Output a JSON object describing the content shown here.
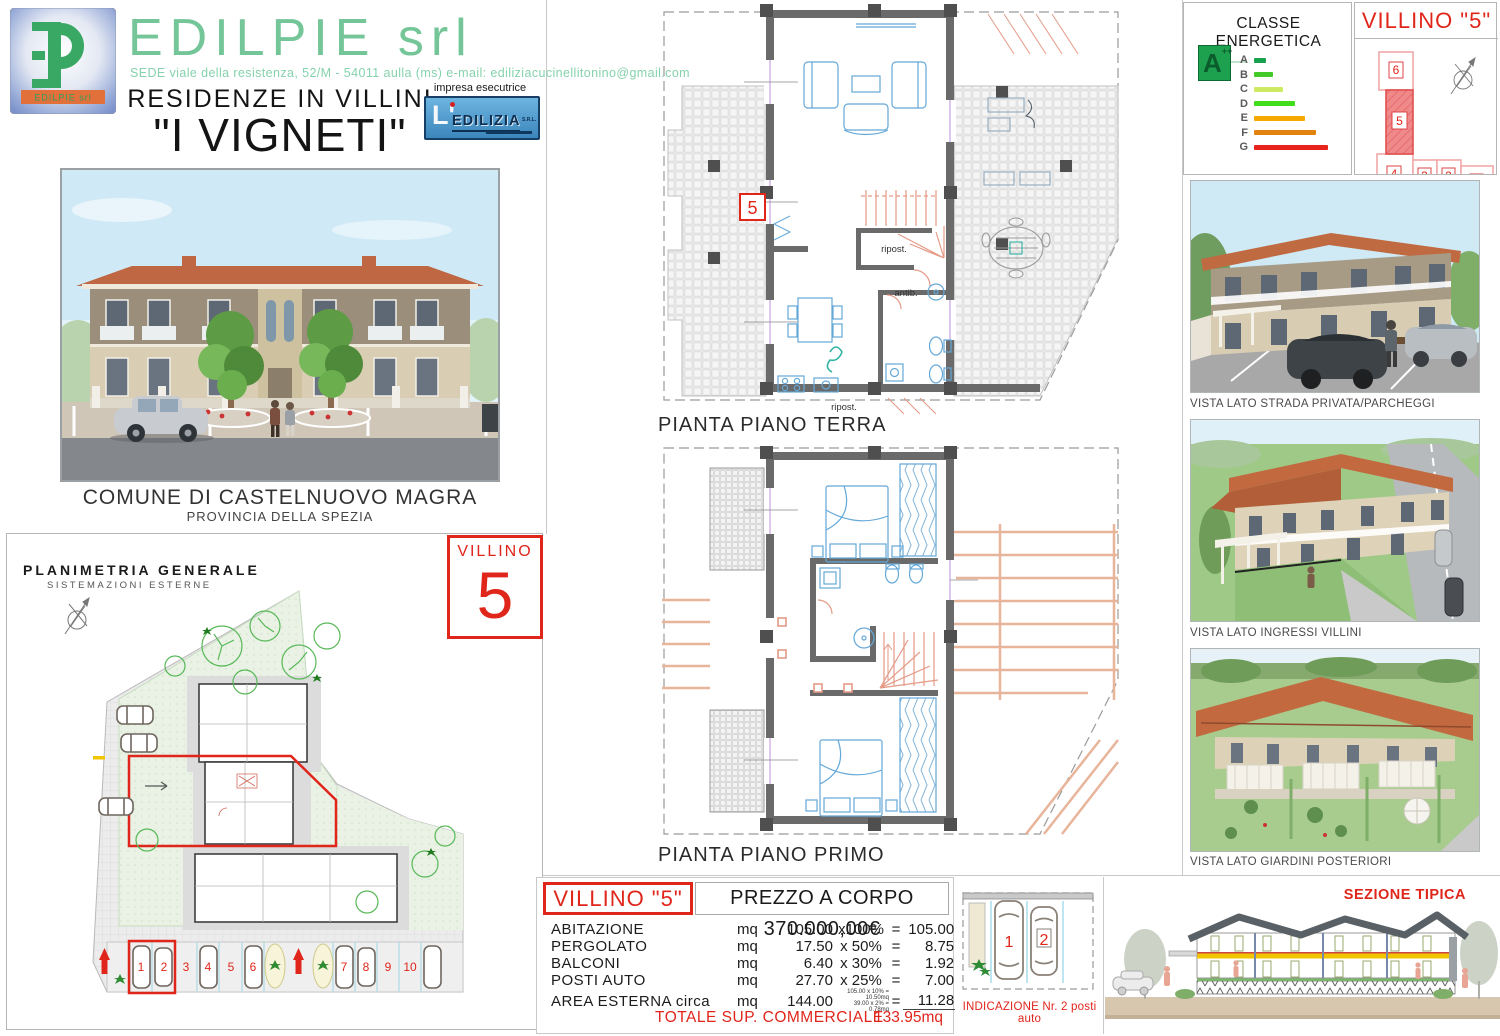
{
  "colors": {
    "brand_green": "#74c698",
    "address_green": "#85d2ad",
    "accent_red": "#e0251b",
    "plan_wall_gray": "#6a6a6a",
    "furniture_blue": "#64a8d8",
    "stairs_salmon": "#e59a86"
  },
  "header": {
    "company": "EDILPIE srl",
    "address": "SEDE viale della resistenza, 52/M - 54011 aulla (ms) e-mail: ediliziacucinellitonino@gmail.com",
    "logo_caption": "EDILPIE srl",
    "subtitle": "RESIDENZE IN VILLINI",
    "title": "\"I VIGNETI\"",
    "contractor_label": "impresa esecutrice",
    "contractor_name": "EDILIZIA",
    "contractor_prefix": "L'",
    "contractor_suffix": "S.R.L."
  },
  "location": {
    "municipality": "COMUNE DI CASTELNUOVO MAGRA",
    "province": "PROVINCIA DELLA SPEZIA"
  },
  "site_plan": {
    "title": "PLANIMETRIA GENERALE",
    "subtitle": "SISTEMAZIONI ESTERNE",
    "parking_numbers": [
      "1",
      "2",
      "3",
      "4",
      "5",
      "6",
      "7",
      "8",
      "9",
      "10"
    ]
  },
  "villino_badge": {
    "label": "VILLINO",
    "number": "5"
  },
  "floor_plans": {
    "ground": {
      "caption": "PIANTA PIANO TERRA",
      "marker": "5",
      "label_storage": "ripost.",
      "label_anteroom": "antib.",
      "label_storage2": "ripost."
    },
    "first": {
      "caption": "PIANTA PIANO PRIMO"
    }
  },
  "energy": {
    "title": "CLASSE ENERGETICA",
    "rating_letter": "A",
    "rating_sup": "++",
    "classes": [
      {
        "label": "A",
        "color": "#17a04d",
        "width": "12px"
      },
      {
        "label": "B",
        "color": "#44ca28",
        "width": "19px"
      },
      {
        "label": "C",
        "color": "#cdea62",
        "width": "29px"
      },
      {
        "label": "D",
        "color": "#3fdd1a",
        "width": "41px"
      },
      {
        "label": "E",
        "color": "#f6a800",
        "width": "51px"
      },
      {
        "label": "F",
        "color": "#e2820f",
        "width": "62px"
      },
      {
        "label": "G",
        "color": "#e8231c",
        "width": "74px"
      }
    ]
  },
  "unit_map": {
    "title": "VILLINO \"5\"",
    "units": [
      "6",
      "5",
      "4",
      "3",
      "2",
      "1"
    ],
    "highlighted": "5"
  },
  "views": {
    "street": "VISTA LATO STRADA PRIVATA/PARCHEGGI",
    "entrances": "VISTA LATO INGRESSI VILLINI",
    "gardens": "VISTA LATO GIARDINI POSTERIORI"
  },
  "price_table": {
    "unit_label": "VILLINO \"5\"",
    "price_label": "PREZZO A CORPO 370.000,00€",
    "rows": [
      {
        "name": "ABITAZIONE",
        "mq": "mq",
        "value": "105.00",
        "factor": "x100%",
        "eq": "=",
        "result": "105.00mq"
      },
      {
        "name": "PERGOLATO",
        "mq": "mq",
        "value": "17.50",
        "factor": "x 50%",
        "eq": "=",
        "result": "8.75mq"
      },
      {
        "name": "BALCONI",
        "mq": "mq",
        "value": "6.40",
        "factor": "x 30%",
        "eq": "=",
        "result": "1.92mq"
      },
      {
        "name": "POSTI AUTO",
        "mq": "mq",
        "value": "27.70",
        "factor": "x 25%",
        "eq": "=",
        "result": "7.00mq"
      },
      {
        "name": "AREA ESTERNA circa",
        "mq": "mq",
        "value": "144.00",
        "note1": "105.00 x 10% = 10.50mq",
        "note2": "39.00 x  2% =  0.78mq",
        "eq": "=",
        "result": "11.28mq"
      }
    ],
    "total_label": "TOTALE SUP. COMMERCIALE",
    "total_value": "133.95mq"
  },
  "parking_detail": {
    "caption": "INDICAZIONE  Nr. 2 posti auto",
    "spots": [
      "1",
      "2"
    ]
  },
  "section": {
    "caption": "SEZIONE TIPICA"
  }
}
